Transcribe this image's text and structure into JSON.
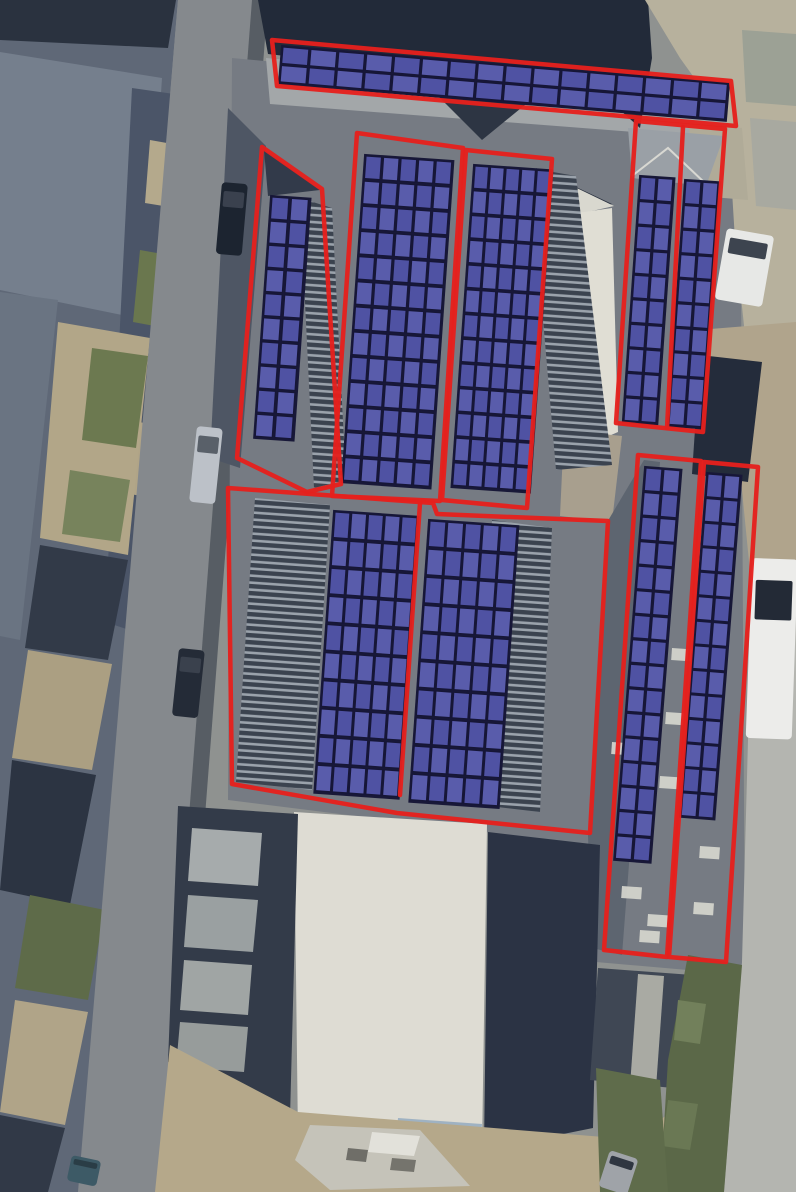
{
  "meta": {
    "title": "Aerial roof plan with proposed solar PV panel layout",
    "canvas_width": 796,
    "canvas_height": 1192
  },
  "palette": {
    "base": "#8f9290",
    "zone_outline": "#e5201d",
    "panel_fill_a": "#4f52a3",
    "panel_fill_b": "#595cab",
    "panel_grid": "#161637",
    "panel_backing": "#181838",
    "stripe_dark": "#3b434f",
    "stripe_light": "#9aa2ab",
    "skylight": "#d6d6ce"
  },
  "background": {
    "shapes": [
      {
        "name": "houses-base",
        "points": "0,0 178,0 80,1192 0,1192",
        "fill": "#5f6877"
      },
      {
        "name": "houses-dark-top",
        "points": "0,0 176,0 168,48 0,40",
        "fill": "#2a323f"
      },
      {
        "name": "houses-roof-plane-1",
        "points": "0,52 162,78 146,320 0,290",
        "fill": "#757f8d"
      },
      {
        "name": "houses-back-row",
        "points": "132,88 216,100 160,640 105,622",
        "fill": "#4b5568"
      },
      {
        "name": "yard-1",
        "points": "150,140 195,148 188,210 145,203",
        "fill": "#b4a98c"
      },
      {
        "name": "garden-1",
        "points": "140,250 185,258 176,330 133,322",
        "fill": "#6a774e"
      },
      {
        "name": "yard-2",
        "points": "128,420 172,428 162,500 120,492",
        "fill": "#b0a487"
      },
      {
        "name": "yard-col-1",
        "points": "58,322 150,338 128,555 40,538",
        "fill": "#b2a688"
      },
      {
        "name": "garden-2",
        "points": "92,348 148,356 136,448 82,440",
        "fill": "#6c7950"
      },
      {
        "name": "garden-3",
        "points": "70,470 130,480 120,542 62,534",
        "fill": "#77835c"
      },
      {
        "name": "houses-roof-plane-2",
        "points": "0,292 58,300 20,640 0,636",
        "fill": "#6a7482"
      },
      {
        "name": "houses-dark-row-1",
        "points": "40,545 128,560 108,660 25,648",
        "fill": "#323a48"
      },
      {
        "name": "yard-col-2",
        "points": "28,650 112,664 92,770 12,758",
        "fill": "#ab9f82"
      },
      {
        "name": "houses-dark-row-2",
        "points": "12,760 96,775 70,905 0,890",
        "fill": "#2c3442"
      },
      {
        "name": "garden-4",
        "points": "30,895 105,910 88,1000 15,988",
        "fill": "#5e6b49"
      },
      {
        "name": "yard-col-3",
        "points": "15,1000 88,1012 65,1125 0,1112",
        "fill": "#b0a488"
      },
      {
        "name": "houses-dark-bottom",
        "points": "0,1115 65,1128 48,1192 0,1192",
        "fill": "#313947"
      },
      {
        "name": "left-road",
        "points": "178,0 252,0 160,1192 78,1192",
        "fill": "#85898d"
      },
      {
        "name": "road-edge-shadow",
        "points": "252,0 268,0 176,1192 160,1192",
        "fill": "#39414d",
        "opacity": 0.65
      },
      {
        "name": "main-roof",
        "points": "232,58 740,105 745,975 596,962 588,845 228,800",
        "fill": "#767b83"
      },
      {
        "name": "roof-dark-left-band",
        "points": "228,108 266,146 240,468 210,458",
        "fill": "#4e5664"
      },
      {
        "name": "eaves-band",
        "points": "266,58 737,100 739,140 270,104",
        "fill": "#a3a7a9"
      },
      {
        "name": "hip-triangle-top",
        "points": "436,94 526,104 482,140",
        "fill": "#2d3543"
      },
      {
        "name": "dark-roof-top",
        "points": "258,0 648,0 652,58 640,128 600,92 268,54",
        "fill": "#222a39"
      },
      {
        "name": "zone2-dark-fill",
        "points": "264,150 320,190 268,196",
        "fill": "#323a4a"
      },
      {
        "name": "pavement-top-right",
        "points": "645,0 796,0 796,330 745,335 735,240 728,125 680,58",
        "fill": "#b7b19d"
      },
      {
        "name": "slab-1",
        "points": "742,30 796,34 796,106 746,102",
        "fill": "#9ca195"
      },
      {
        "name": "slab-2",
        "points": "750,118 796,122 796,210 756,206",
        "fill": "#a8a9a0"
      },
      {
        "name": "slab-3",
        "points": "688,122 742,128 748,200 700,196",
        "fill": "#b0ab98"
      },
      {
        "name": "dirt-right",
        "points": "698,330 796,322 796,600 752,592 740,470 694,470",
        "fill": "#b0a48c"
      },
      {
        "name": "right-road",
        "points": "752,592 796,600 796,1192 724,1192 742,962",
        "fill": "#b4b5b0"
      },
      {
        "name": "dark-roof-right-mid",
        "points": "700,355 762,362 748,482 692,474",
        "fill": "#242c3b"
      },
      {
        "name": "hip-shadow-left-of-wedge",
        "points": "536,168 612,204 562,214",
        "fill": "#2b3240"
      },
      {
        "name": "cream-ridge-triangle",
        "points": "556,178 614,206 570,216",
        "fill": "#d9d8cf"
      },
      {
        "name": "cream-wedge",
        "points": "570,214 612,208 618,432 586,446 566,302",
        "fill": "#e0ded4"
      },
      {
        "name": "gravel-below-wedge",
        "points": "564,430 622,436 612,522 560,516",
        "fill": "#a89f8e"
      },
      {
        "name": "zone5-top-gray",
        "points": "628,128 724,136 706,186 632,178",
        "fill": "#9aa0a6"
      },
      {
        "name": "gap-column-z6-z7",
        "points": "606,524 644,460 660,462 622,955 592,948 588,836",
        "fill": "#5d6570"
      },
      {
        "name": "white-building",
        "points": "294,812 487,824 482,1148 298,1138",
        "fill": "#dedcd3"
      },
      {
        "name": "white-building-blue-edge",
        "points": "398,1118 482,1124 480,1148 396,1142",
        "fill": "#9fb2c2"
      },
      {
        "name": "dark-roof-bottom-right",
        "points": "488,832 600,845 593,1128 484,1150",
        "fill": "#2b3344"
      },
      {
        "name": "yard-dark-frame",
        "points": "178,806 298,814 290,1118 168,1062",
        "fill": "#333b49"
      },
      {
        "name": "yard-step-1",
        "points": "192,828 262,833 258,886 188,881",
        "fill": "#a6abac"
      },
      {
        "name": "yard-step-2",
        "points": "188,895 258,900 253,952 184,947",
        "fill": "#9aa0a1"
      },
      {
        "name": "yard-step-3",
        "points": "184,960 252,965 248,1015 180,1010",
        "fill": "#a0a5a4"
      },
      {
        "name": "yard-step-4",
        "points": "180,1022 248,1027 244,1072 176,1067",
        "fill": "#979c9b"
      },
      {
        "name": "ground-bottom",
        "points": "170,1045 298,1112 640,1140 688,1094 724,1192 155,1192",
        "fill": "#b5a88a"
      },
      {
        "name": "courtyard-bottom-right",
        "points": "598,968 706,976 694,1090 590,1080",
        "fill": "#3f4754"
      },
      {
        "name": "courtyard-path",
        "points": "638,974 664,976 656,1088 630,1086",
        "fill": "#a9aaa3"
      },
      {
        "name": "greenery-right",
        "points": "688,955 742,965 724,1192 660,1192 668,1060",
        "fill": "#5b6848"
      },
      {
        "name": "green-blob-1",
        "points": "678,1000 706,1004 700,1044 674,1040",
        "fill": "#72805b"
      },
      {
        "name": "green-blob-2",
        "points": "668,1100 698,1104 690,1150 662,1146",
        "fill": "#6a7854"
      },
      {
        "name": "greenery-bottom-mid",
        "points": "596,1068 660,1080 668,1192 600,1192",
        "fill": "#5f6c4b"
      },
      {
        "name": "rubble-pile",
        "points": "310,1125 420,1130 470,1186 330,1190 295,1160",
        "fill": "#c5c3b9"
      },
      {
        "name": "rubble-light",
        "points": "372,1132 420,1136 414,1156 368,1152",
        "fill": "#e2e1da"
      },
      {
        "name": "rubble-dark-1",
        "points": "348,1148 368,1150 366,1162 346,1160",
        "fill": "#6f6e68"
      },
      {
        "name": "rubble-dark-2",
        "points": "392,1158 416,1160 414,1172 390,1170",
        "fill": "#75746d"
      },
      {
        "name": "stripes-z2",
        "points": "300,198 332,208 346,480 314,488",
        "stripes": true
      },
      {
        "name": "stripes-right-of-z4",
        "points": "530,168 576,176 612,465 556,470",
        "stripes": true
      },
      {
        "name": "stripes-z6-left",
        "points": "255,498 330,505 312,790 236,782",
        "stripes": true
      },
      {
        "name": "stripes-z6-right",
        "points": "492,520 552,528 540,812 480,805",
        "stripes": true
      },
      {
        "name": "ridge-line",
        "line": "632,176 668,148 706,184",
        "stroke": "#d8d8d2",
        "stroke_width": 2
      }
    ]
  },
  "skylights": {
    "size": [
      20,
      12
    ],
    "angle": 4,
    "positions": [
      [
        672,
        648
      ],
      [
        666,
        712
      ],
      [
        660,
        776
      ],
      [
        612,
        742
      ],
      [
        622,
        886
      ],
      [
        648,
        914
      ],
      [
        700,
        846
      ],
      [
        694,
        902
      ],
      [
        640,
        930
      ]
    ]
  },
  "vehicles": [
    {
      "name": "car-dark-top",
      "x": 222,
      "y": 182,
      "w": 26,
      "h": 72,
      "angle": 5,
      "body": "#1c2430",
      "window": "#3a414e"
    },
    {
      "name": "car-silver-left",
      "x": 197,
      "y": 426,
      "w": 26,
      "h": 76,
      "angle": 6,
      "body": "#bcc1c8",
      "window": "#596069"
    },
    {
      "name": "car-dark-mid",
      "x": 179,
      "y": 648,
      "w": 26,
      "h": 68,
      "angle": 6,
      "body": "#242b37",
      "window": "#3a414d"
    },
    {
      "name": "van-white-right",
      "x": 752,
      "y": 558,
      "w": 46,
      "h": 180,
      "angle": 2,
      "body": "#ececea",
      "window": "#232a36"
    },
    {
      "name": "car-white-top-right",
      "x": 727,
      "y": 228,
      "w": 48,
      "h": 72,
      "angle": 10,
      "body": "#e7e8e6",
      "window": "#3d444f"
    },
    {
      "name": "car-gray-bottom",
      "x": 610,
      "y": 1150,
      "w": 30,
      "h": 38,
      "angle": 18,
      "body": "#9fa3a8",
      "window": "#2f3641"
    },
    {
      "name": "car-teal-bottom-left",
      "x": 72,
      "y": 1155,
      "w": 30,
      "h": 26,
      "angle": 12,
      "body": "#3d5a66",
      "window": "#2a3d46"
    }
  ],
  "zones": [
    {
      "id": "top-strip",
      "outline": "272,40 731,81 736,126 277,86"
    },
    {
      "id": "left-wing",
      "outline": "262,147 322,189 341,484 307,492 237,458"
    },
    {
      "id": "center-left",
      "outline": "357,133 463,148 440,501 332,496"
    },
    {
      "id": "center-right",
      "outline": "466,150 552,159 527,508 442,500"
    },
    {
      "id": "upper-right",
      "outline": "636,121 725,129 703,432 616,423",
      "divider": "683,127 667,428"
    },
    {
      "id": "lower-center",
      "outline": "228,488 433,503 437,514 608,521 590,833 397,813 232,784",
      "divider": "420,503 400,795"
    },
    {
      "id": "lower-right-a",
      "outline": "638,455 701,461 667,957 604,950"
    },
    {
      "id": "lower-right-b",
      "outline": "704,462 758,467 726,962 669,957"
    }
  ],
  "panel_blocks": [
    {
      "id": "top-strip-array",
      "x": 283,
      "y": 47,
      "angle": 4.8,
      "cols": 16,
      "rows": 2,
      "pw": 26,
      "ph": 16.5,
      "gx": 2,
      "gy": 2
    },
    {
      "id": "left-wing-array",
      "x": 272,
      "y": 197,
      "angle": 4,
      "cols": 2,
      "rows": 10,
      "pw": 17,
      "ph": 22,
      "gx": 2.5,
      "gy": 2.2
    },
    {
      "id": "center-left-array",
      "x": 366,
      "y": 156,
      "angle": 4,
      "cols": 5,
      "rows": 13,
      "pw": 15.6,
      "ph": 22.6,
      "gx": 2,
      "gy": 2.6
    },
    {
      "id": "center-right-array",
      "x": 475,
      "y": 166,
      "angle": 4,
      "cols": 5,
      "rows": 13,
      "pw": 13.8,
      "ph": 22.4,
      "gx": 1.8,
      "gy": 2.4
    },
    {
      "id": "upper-right-array-a",
      "x": 641,
      "y": 177,
      "angle": 4,
      "cols": 2,
      "rows": 10,
      "pw": 15,
      "ph": 22.6,
      "gx": 2,
      "gy": 2
    },
    {
      "id": "upper-right-array-b",
      "x": 686,
      "y": 181,
      "angle": 4,
      "cols": 2,
      "rows": 10,
      "pw": 15,
      "ph": 22.6,
      "gx": 2,
      "gy": 2
    },
    {
      "id": "lower-center-array-a",
      "x": 335,
      "y": 512,
      "angle": 4,
      "cols": 5,
      "rows": 10,
      "pw": 15,
      "ph": 25.6,
      "gx": 1.8,
      "gy": 2.6
    },
    {
      "id": "lower-center-array-b",
      "x": 430,
      "y": 521,
      "angle": 4,
      "cols": 5,
      "rows": 10,
      "pw": 16,
      "ph": 25.6,
      "gx": 1.8,
      "gy": 2.6
    },
    {
      "id": "lower-right-array-a",
      "x": 646,
      "y": 468,
      "angle": 4.5,
      "cols": 2,
      "rows": 16,
      "pw": 16,
      "ph": 22.6,
      "gx": 2,
      "gy": 2
    },
    {
      "id": "lower-right-array-b",
      "x": 708,
      "y": 474,
      "angle": 4.5,
      "cols": 2,
      "rows": 14,
      "pw": 15,
      "ph": 22.8,
      "gx": 2,
      "gy": 1.8
    }
  ]
}
